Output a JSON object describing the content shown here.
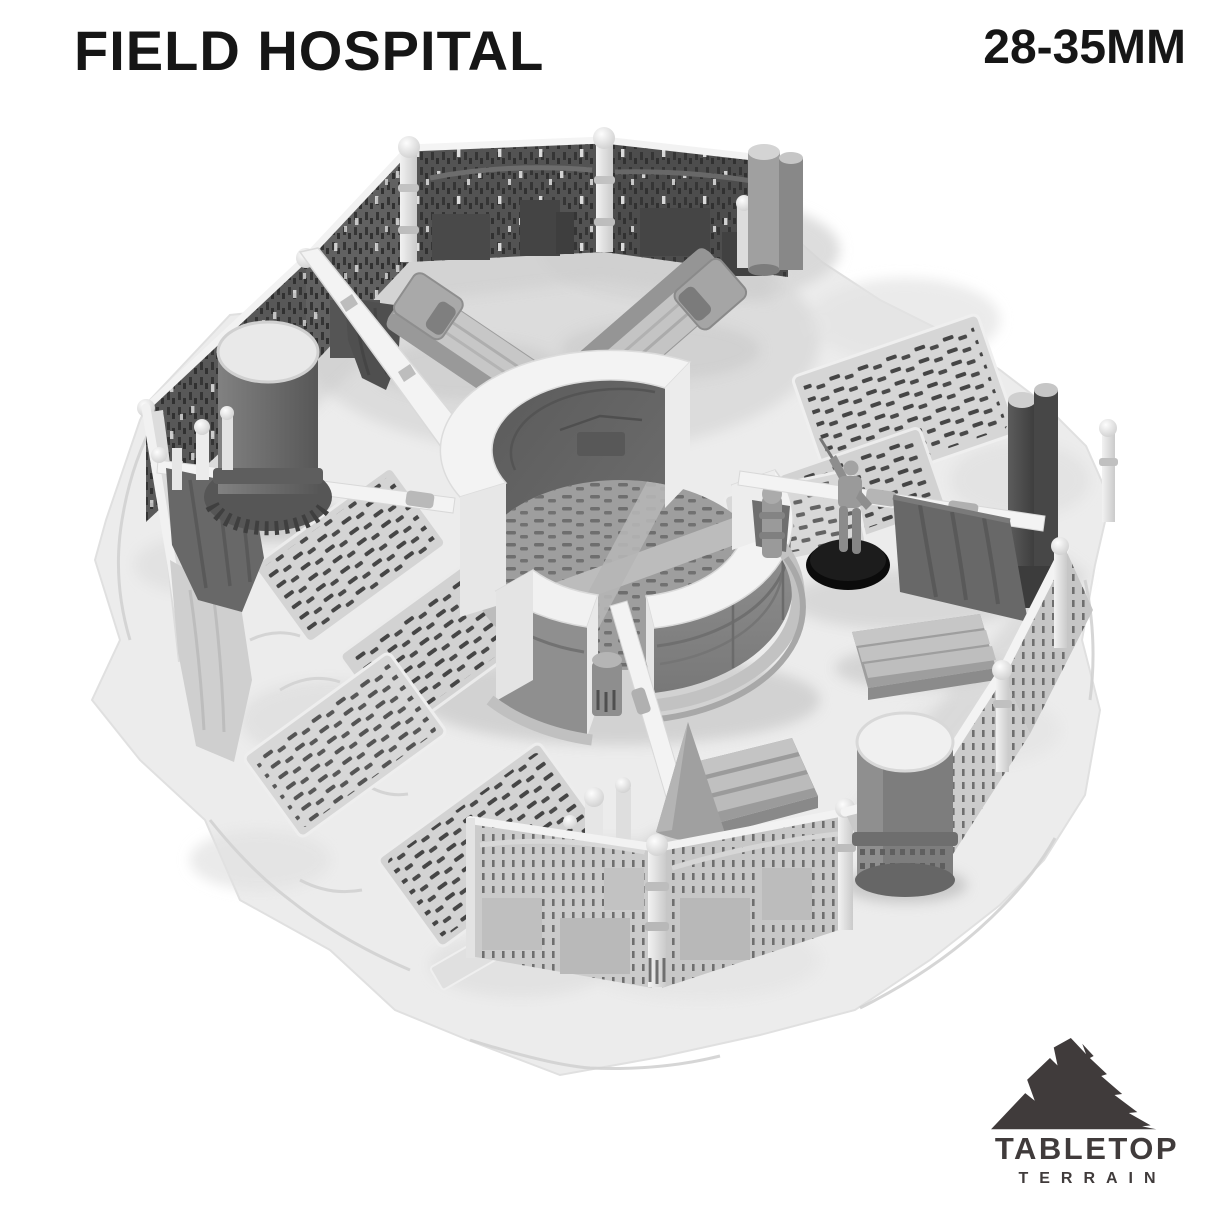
{
  "page": {
    "background_color": "#ffffff"
  },
  "header": {
    "title": "FIELD HOSPITAL",
    "scale_label": "28-35MM",
    "text_color": "#161616"
  },
  "brand_logo": {
    "name": "TABLETOP",
    "subtitle": "TERRAIN",
    "color": "#403b3b",
    "icon": "mountain-icon"
  },
  "product_render": {
    "alt": "Grayscale 3D render of the Field Hospital modular sci-fi terrain set: a circular central structure of two curved walls with white rims, perforated perimeter walls with ball-topped posts, two hooded medical beds, supply tanks, hanging curtains, slatted pallets, textured floor plates and a 28mm miniature on a black base, all on an irregular rocky ground base",
    "colors": {
      "terrain_base": "#ececec",
      "dark_walls": "#585858",
      "light_walls": "#cbcbcb",
      "structure_wall": "#8a8a8a",
      "rims_and_beams": "#f3f3f3",
      "curtain": "#686868",
      "figure_base": "#0b0b0b"
    }
  }
}
